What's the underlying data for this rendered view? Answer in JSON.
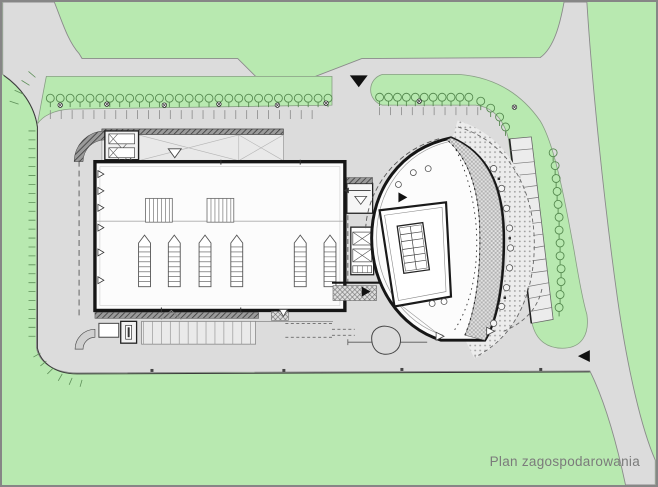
{
  "plan": {
    "caption": "Plan zagospodarowania"
  },
  "colors": {
    "frame_border": "#868686",
    "grass_green": "#b8e9b0",
    "pavement_gray": "#dcdcdc",
    "building_fill": "#fcfcfc",
    "wall_black": "#161616",
    "line_gray": "#8a8a8a",
    "tree_stroke": "#55894f",
    "caption_text": "#7b7b7b"
  }
}
